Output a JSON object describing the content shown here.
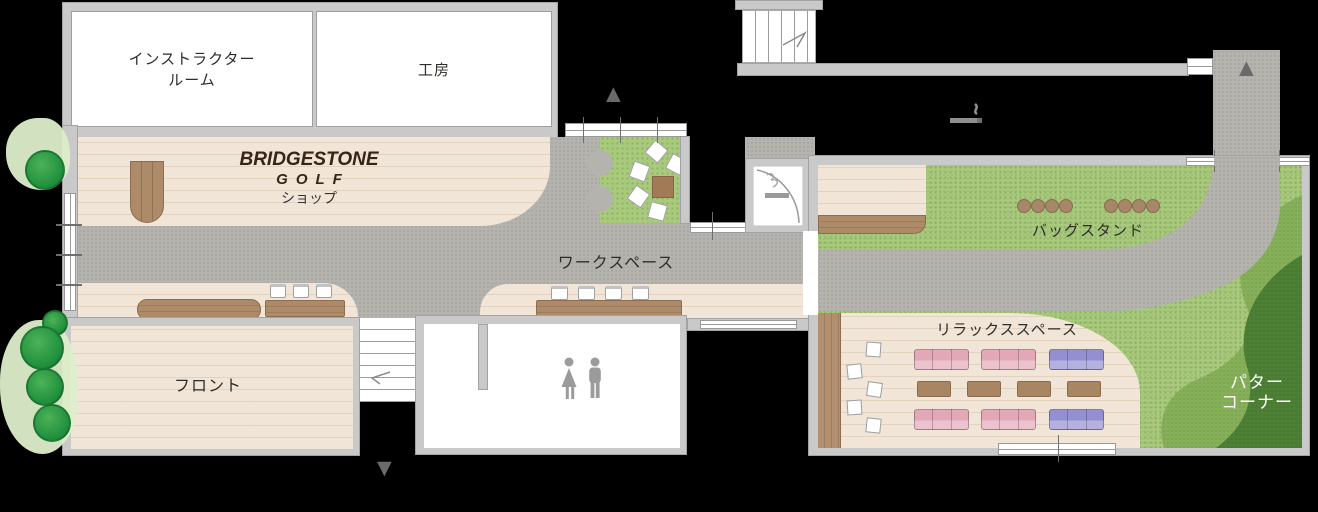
{
  "plan": {
    "rooms": {
      "instructor_room": {
        "label_line1": "インストラクター",
        "label_line2": "ルーム"
      },
      "workshop": {
        "label": "工房"
      },
      "shop": {
        "brand_line1": "BRIDGESTONE",
        "brand_line2": "GOLF",
        "label": "ショップ"
      },
      "front_desk": {
        "label": "フロント"
      },
      "workspace": {
        "label": "ワークスペース"
      },
      "bag_stand": {
        "label": "バッグスタンド"
      },
      "relax_space": {
        "label": "リラックススペース"
      },
      "putter_corner": {
        "label_line1": "パター",
        "label_line2": "コーナー"
      }
    },
    "icons": {
      "entrance_arrow_top": "▲",
      "entrance_arrow_northeast": "▲",
      "exit_arrow_bottom": "▼",
      "smoking_icon": "cigarette",
      "restroom_icon": "man-woman pictogram",
      "upper_stairs": "staircase",
      "lower_stairs": "staircase",
      "entry_door": "door with swing arc",
      "trees": "round landscape trees"
    },
    "colors": {
      "bg": "#000000",
      "wall": "#c9c9c9",
      "wall_line": "#a3a3a3",
      "room": "#ffffff",
      "wood": "#f0e5d6",
      "walkway": "#b5b3ae",
      "grass": "#a9ca7d",
      "green_mid": "#85af58",
      "green_dark": "#4d7f35",
      "counter": "#ad8a68",
      "counter_dark": "#8d6d52",
      "sofa_pink": "#e2a8b8",
      "sofa_purple": "#938fd1",
      "table_brown": "#a98663",
      "icon_gray": "#9b9b9b",
      "arrow_gray": "#6a6a6a",
      "label_text": "#2f2d2a",
      "logo_text": "#352517",
      "putter_text": "#ffffff"
    }
  }
}
